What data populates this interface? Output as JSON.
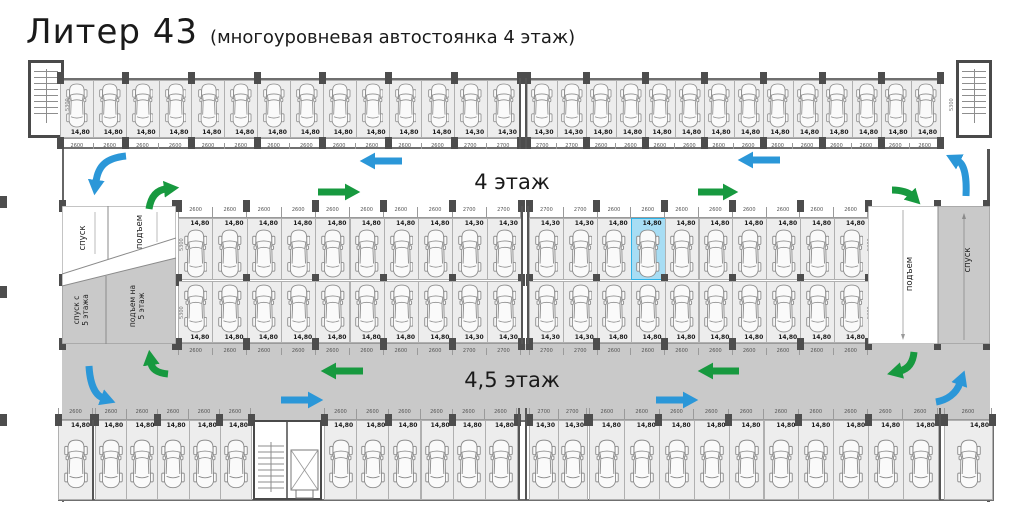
{
  "title": {
    "main": "Литер 43",
    "subtitle": "(многоуровневая автостоянка 4 этаж)"
  },
  "aisles": {
    "upper": "4 этаж",
    "lower": "4,5 этаж"
  },
  "ramps": {
    "left_upper": [
      {
        "label": "спуск"
      },
      {
        "label": "подъем"
      }
    ],
    "left_lower": [
      {
        "lines": [
          "спуск с",
          "5 этажа"
        ]
      },
      {
        "lines": [
          "подъем на",
          "5 этаж"
        ]
      }
    ],
    "right": [
      {
        "label": "подъем"
      },
      {
        "label": "спуск"
      }
    ]
  },
  "depth_dim": "5300",
  "colors": {
    "space_fill": "#ededed",
    "aisle_gray": "#c9c9c9",
    "highlight_fill": "#a7ddf4",
    "highlight_border": "#2fb2e6",
    "arrow_blue": "#2b97d8",
    "arrow_green": "#17993f",
    "pillar": "#4d4d4d"
  },
  "highlight": {
    "row": "mid-upper",
    "section": 1,
    "index": 3,
    "area": "14,80"
  },
  "plan": {
    "rows": [
      {
        "id": "top",
        "y": 80,
        "h": 58,
        "labelPos": "bottom",
        "dimY": 138,
        "dimH": 11,
        "dimSide": "below",
        "pillarYs": [
          72,
          137
        ],
        "sections": [
          {
            "x": 60,
            "w": 460,
            "groups": [
              {
                "n": 12,
                "a": "14,80",
                "d": "2600"
              },
              {
                "n": 2,
                "a": "14,30",
                "d": "2700"
              }
            ]
          },
          {
            "x": 527,
            "w": 413,
            "groups": [
              {
                "n": 2,
                "a": "14,30",
                "d": "2700"
              },
              {
                "n": 12,
                "a": "14,80",
                "d": "2600"
              }
            ]
          }
        ]
      },
      {
        "id": "mid-upper",
        "y": 218,
        "h": 62,
        "labelPos": "top",
        "dimY": 206,
        "dimH": 12,
        "dimSide": "above",
        "pillarYs": [
          200,
          274
        ],
        "sections": [
          {
            "x": 178,
            "w": 343,
            "groups": [
              {
                "n": 8,
                "a": "14,80",
                "d": "2600"
              },
              {
                "n": 2,
                "a": "14,30",
                "d": "2700"
              }
            ]
          },
          {
            "x": 529,
            "w": 339,
            "groups": [
              {
                "n": 2,
                "a": "14,30",
                "d": "2700"
              },
              {
                "n": 8,
                "a": "14,80",
                "d": "2600"
              }
            ]
          }
        ]
      },
      {
        "id": "mid-lower",
        "y": 281,
        "h": 62,
        "labelPos": "bottom",
        "dimY": 343,
        "dimH": 12,
        "dimSide": "below",
        "pillarYs": [
          338
        ],
        "sections": [
          {
            "x": 178,
            "w": 343,
            "groups": [
              {
                "n": 8,
                "a": "14,80",
                "d": "2600"
              },
              {
                "n": 2,
                "a": "14,30",
                "d": "2700"
              }
            ]
          },
          {
            "x": 529,
            "w": 339,
            "groups": [
              {
                "n": 2,
                "a": "14,30",
                "d": "2700"
              },
              {
                "n": 8,
                "a": "14,80",
                "d": "2600"
              }
            ]
          }
        ]
      },
      {
        "id": "bottom",
        "y": 420,
        "h": 80,
        "labelPos": "top",
        "dimY": 408,
        "dimH": 12,
        "dimSide": "above",
        "pillarYs": [
          414
        ],
        "sections": [
          {
            "x": 58,
            "w": 35,
            "groups": [
              {
                "n": 1,
                "a": "14,80",
                "d": "2600"
              }
            ]
          },
          {
            "x": 95,
            "w": 156,
            "groups": [
              {
                "n": 5,
                "a": "14,80",
                "d": "2600"
              }
            ]
          },
          {
            "x": 324,
            "w": 193,
            "groups": [
              {
                "n": 6,
                "a": "14,80",
                "d": "2600"
              }
            ]
          },
          {
            "x": 529,
            "w": 58,
            "groups": [
              {
                "n": 2,
                "a": "14,30",
                "d": "2700"
              }
            ]
          },
          {
            "x": 589,
            "w": 349,
            "groups": [
              {
                "n": 10,
                "a": "14,80",
                "d": "2600"
              }
            ]
          },
          {
            "x": 944,
            "w": 48,
            "groups": [
              {
                "n": 1,
                "a": "14,80",
                "d": "2600"
              }
            ]
          }
        ]
      }
    ],
    "walls": [
      {
        "x": 519,
        "y": 78,
        "h": 71
      },
      {
        "x": 525,
        "y": 78,
        "h": 71
      },
      {
        "x": 521,
        "y": 206,
        "h": 138
      },
      {
        "x": 527,
        "y": 206,
        "h": 138
      },
      {
        "x": 518,
        "y": 408,
        "h": 92
      },
      {
        "x": 525,
        "y": 408,
        "h": 92
      },
      {
        "x": 939,
        "y": 408,
        "h": 92
      },
      {
        "x": 92,
        "y": 420,
        "h": 80
      }
    ],
    "pillars": [
      {
        "x": 59,
        "y": 200
      },
      {
        "x": 59,
        "y": 274
      },
      {
        "x": 59,
        "y": 338
      },
      {
        "x": 172,
        "y": 200
      },
      {
        "x": 172,
        "y": 274
      },
      {
        "x": 172,
        "y": 338
      },
      {
        "x": 934,
        "y": 200
      },
      {
        "x": 934,
        "y": 274
      },
      {
        "x": 934,
        "y": 338
      },
      {
        "x": 983,
        "y": 200
      },
      {
        "x": 983,
        "y": 274
      },
      {
        "x": 983,
        "y": 338
      },
      {
        "x": 0,
        "y": 196
      },
      {
        "x": 0,
        "y": 286
      },
      {
        "x": 0,
        "y": 414
      }
    ],
    "side_dims": [
      {
        "x": 60,
        "y": 100
      },
      {
        "x": 944,
        "y": 100
      },
      {
        "x": 174,
        "y": 240
      },
      {
        "x": 174,
        "y": 308
      },
      {
        "x": 862,
        "y": 240
      },
      {
        "x": 862,
        "y": 308
      }
    ]
  }
}
